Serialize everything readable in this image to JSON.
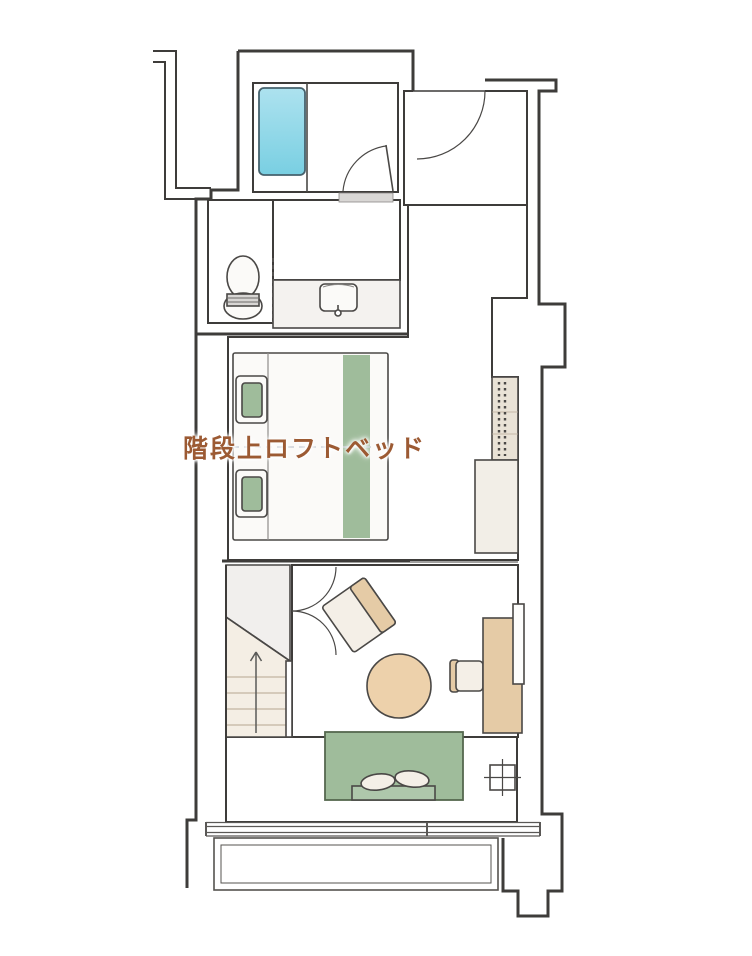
{
  "floorplan": {
    "label": {
      "text": "階段上ロフトベッド"
    },
    "colors": {
      "wall_line": "#3e3c3a",
      "line_soft": "#4a4846",
      "tile_gray": "#c9c6c3",
      "tile_grout": "#a8a5a2",
      "wood_base": "#ece5d8",
      "wood_line": "#c2b4a1",
      "wood_lower": "#f0e9dd",
      "carpet": "#c6beb5",
      "carpet_line": "#a99f95",
      "green": "#9fbc9b",
      "green_dark": "#55684f",
      "tub_light": "#ade2ef",
      "tub_dark": "#79cfe2",
      "tan": "#e5cba6",
      "table_tan": "#edd1ab",
      "cream": "#f4efe7",
      "white_fix": "#fbfaf8",
      "bath_floor": "#edecea",
      "label_brown": "#9c5a33"
    },
    "rooms": [
      {
        "name": "bathroom"
      },
      {
        "name": "entry"
      },
      {
        "name": "toilet-room"
      },
      {
        "name": "vanity"
      },
      {
        "name": "bedroom"
      },
      {
        "name": "living-area"
      },
      {
        "name": "stairs"
      },
      {
        "name": "balcony"
      }
    ],
    "symbols": [
      "bathtub",
      "bathroom-door",
      "entry-door",
      "toilet-bowl",
      "vanity-sink",
      "twin-bed",
      "pillow",
      "bed-runner",
      "hanger-rack",
      "counter",
      "double-door",
      "lounge-chair",
      "round-table",
      "desk",
      "desk-chair",
      "wall-tv",
      "staircase",
      "up-arrow",
      "sofa-bench",
      "cushions",
      "ac-unit",
      "window",
      "balcony"
    ]
  }
}
